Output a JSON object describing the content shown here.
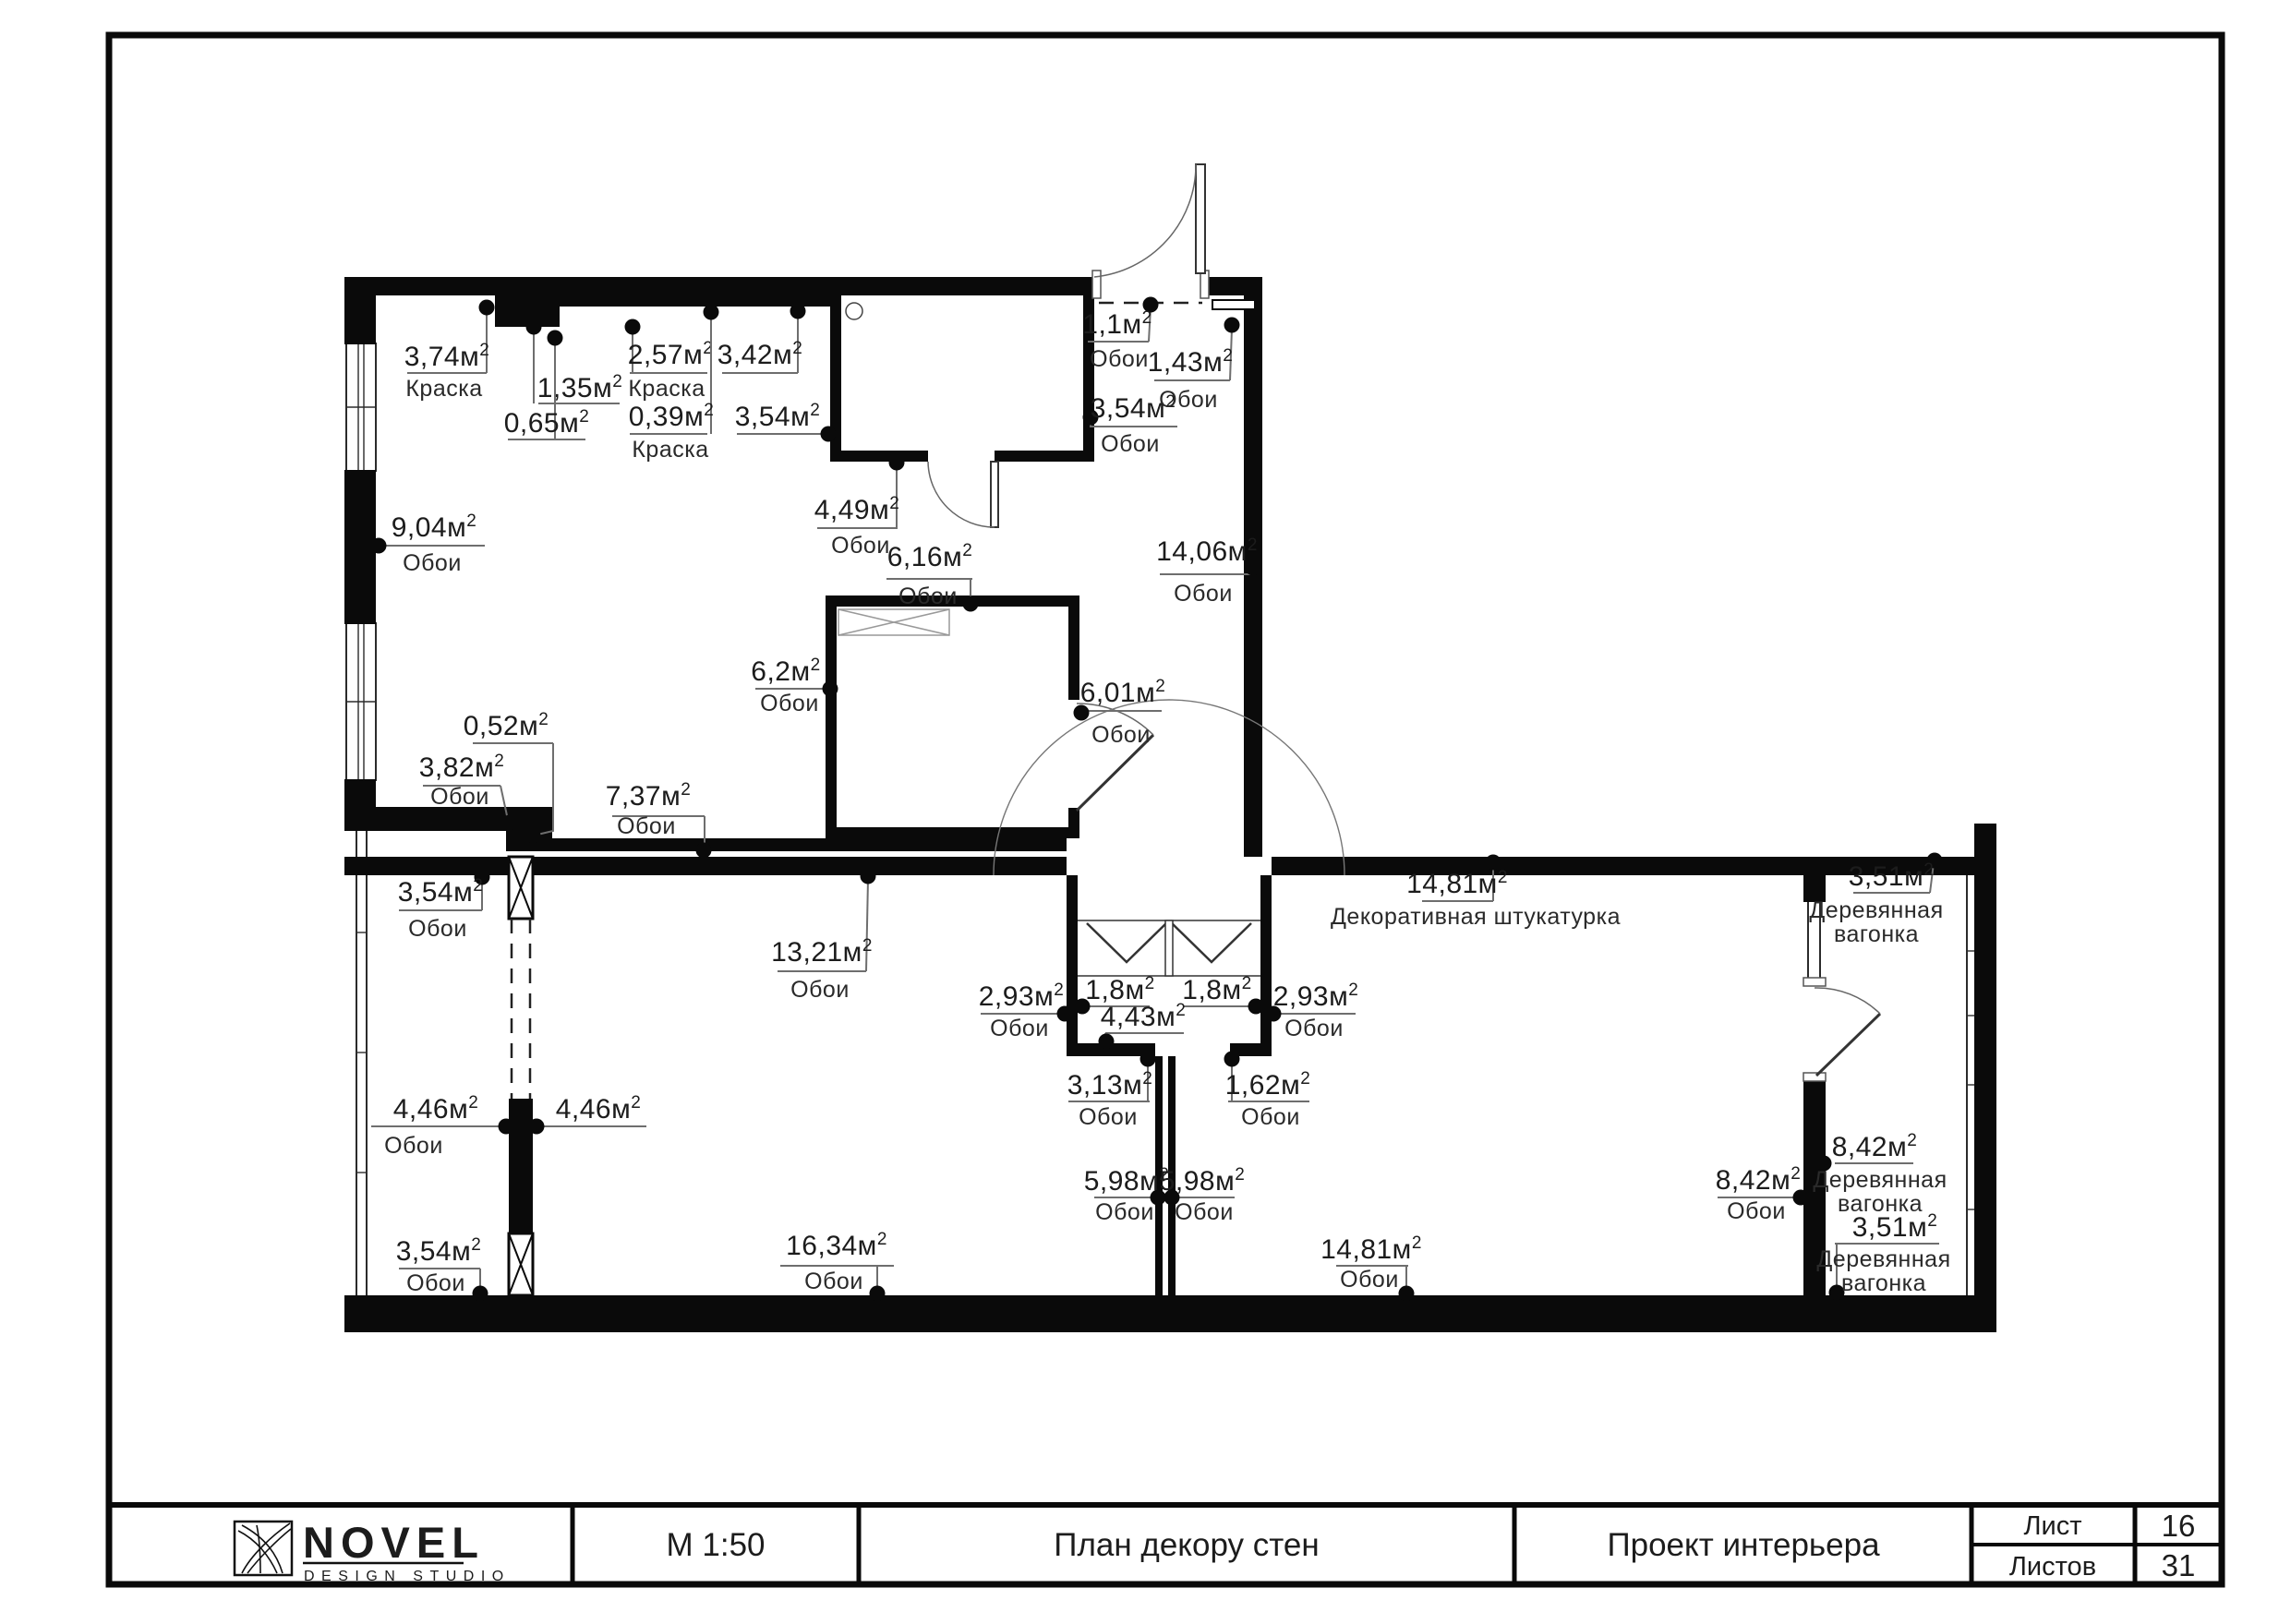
{
  "title_block": {
    "logo_name": "NOVEL",
    "logo_sub": "DESIGN STUDIO",
    "scale": "М 1:50",
    "drawing_title": "План декору стен",
    "project": "Проект интерьера",
    "sheet_label": "Лист",
    "sheet_value": "16",
    "sheets_label": "Листов",
    "sheets_value": "31"
  },
  "legend_note": "Площади стен и материалы отделки",
  "materials_palette": {
    "wallpaper": "Обои",
    "paint": "Краска",
    "decorative_plaster": "Декоративная штукатурка",
    "wood_paneling": "Деревянная вагонка"
  },
  "colors": {
    "walls": "#0a0a0a",
    "leaders": "#6e6e6e",
    "text": "#1c1c1c",
    "background": "#ffffff"
  },
  "labels": [
    {
      "value": "3,74м²",
      "material": "Краска",
      "vx": 484,
      "vy": 396,
      "ul": [
        441,
        527,
        404
      ],
      "mx": 481,
      "my": 429,
      "dot": [
        527,
        333
      ],
      "leader": [
        [
          527,
          404
        ],
        [
          527,
          336
        ]
      ]
    },
    {
      "value": "1,35м²",
      "material": "",
      "vx": 628,
      "vy": 430,
      "ul": [
        583,
        671,
        437
      ],
      "mx": 0,
      "my": 0,
      "dot": [
        578,
        354
      ],
      "leader": [
        [
          578,
          437
        ],
        [
          578,
          357
        ]
      ]
    },
    {
      "value": "0,65м²",
      "material": "",
      "vx": 592,
      "vy": 468,
      "ul": [
        550,
        634,
        476
      ],
      "mx": 0,
      "my": 0,
      "dot": [
        601,
        366
      ],
      "leader": [
        [
          601,
          476
        ],
        [
          601,
          369
        ]
      ]
    },
    {
      "value": "2,57м²",
      "material": "Краска",
      "vx": 726,
      "vy": 394,
      "ul": [
        682,
        766,
        404
      ],
      "mx": 722,
      "my": 429,
      "dot": [
        685,
        354
      ],
      "leader": [
        [
          685,
          404
        ],
        [
          685,
          357
        ]
      ]
    },
    {
      "value": "0,39м²",
      "material": "Краска",
      "vx": 727,
      "vy": 461,
      "ul": [
        682,
        766,
        470
      ],
      "mx": 726,
      "my": 495,
      "dot": [
        770,
        338
      ],
      "leader": [
        [
          770,
          470
        ],
        [
          770,
          341
        ]
      ]
    },
    {
      "value": "3,42м²",
      "material": "",
      "vx": 823,
      "vy": 394,
      "ul": [
        782,
        864,
        404
      ],
      "mx": 0,
      "my": 0,
      "dot": [
        864,
        337
      ],
      "leader": [
        [
          864,
          404
        ],
        [
          864,
          340
        ]
      ]
    },
    {
      "value": "3,54м²",
      "material": "",
      "vx": 842,
      "vy": 461,
      "ul": [
        798,
        885,
        470
      ],
      "mx": 0,
      "my": 0,
      "dot": [
        897,
        470
      ],
      "leader": [
        [
          885,
          470
        ],
        [
          892,
          470
        ]
      ]
    },
    {
      "value": "3,54м²",
      "material": "Обои",
      "vx": 1227,
      "vy": 452,
      "ul": [
        1180,
        1275,
        462
      ],
      "mx": 1224,
      "my": 489,
      "dot": [
        1181,
        452
      ],
      "leader": [
        [
          1181,
          462
        ],
        [
          1181,
          455
        ]
      ]
    },
    {
      "value": "1,1м²",
      "material": "Обои",
      "vx": 1210,
      "vy": 361,
      "ul": [
        1178,
        1244,
        370
      ],
      "mx": 1212,
      "my": 397,
      "dot": [
        1246,
        330
      ],
      "leader": [
        [
          1244,
          370
        ],
        [
          1246,
          333
        ]
      ]
    },
    {
      "value": "1,43м²",
      "material": "Обои",
      "vx": 1289,
      "vy": 402,
      "ul": [
        1250,
        1332,
        412
      ],
      "mx": 1287,
      "my": 441,
      "dot": [
        1334,
        352
      ],
      "leader": [
        [
          1332,
          412
        ],
        [
          1334,
          356
        ]
      ]
    },
    {
      "value": "4,49м²",
      "material": "Обои",
      "vx": 928,
      "vy": 562,
      "ul": [
        885,
        972,
        572
      ],
      "mx": 932,
      "my": 599,
      "dot": [
        971,
        501
      ],
      "leader": [
        [
          971,
          572
        ],
        [
          971,
          504
        ]
      ]
    },
    {
      "value": "9,04м²",
      "material": "Обои",
      "vx": 470,
      "vy": 581,
      "ul": [
        413,
        525,
        591
      ],
      "mx": 468,
      "my": 618,
      "dot": [
        410,
        591
      ],
      "leader": [
        [
          413,
          591
        ],
        [
          411,
          591
        ]
      ]
    },
    {
      "value": "6,16м²",
      "material": "Обои",
      "vx": 1007,
      "vy": 613,
      "ul": [
        960,
        1053,
        627
      ],
      "mx": 1005,
      "my": 654,
      "dot": [
        1051,
        654
      ],
      "leader": [
        [
          1051,
          627
        ],
        [
          1051,
          651
        ]
      ]
    },
    {
      "value": "14,06м²",
      "material": "Обои",
      "vx": 1307,
      "vy": 607,
      "ul": [
        1256,
        1356,
        622
      ],
      "mx": 1303,
      "my": 651,
      "dot": [
        1357,
        615
      ],
      "leader": [
        [
          1356,
          622
        ],
        [
          1357,
          618
        ]
      ]
    },
    {
      "value": "6,2м²",
      "material": "Обои",
      "vx": 851,
      "vy": 737,
      "ul": [
        818,
        893,
        746
      ],
      "mx": 855,
      "my": 770,
      "dot": [
        899,
        746
      ],
      "leader": [
        [
          893,
          746
        ],
        [
          896,
          746
        ]
      ]
    },
    {
      "value": "6,01м²",
      "material": "Обои",
      "vx": 1216,
      "vy": 760,
      "ul": [
        1174,
        1258,
        770
      ],
      "mx": 1214,
      "my": 804,
      "dot": [
        1171,
        772
      ],
      "leader": [
        [
          1174,
          770
        ],
        [
          1172,
          771
        ]
      ]
    },
    {
      "value": "0,52м²",
      "material": "",
      "vx": 548,
      "vy": 796,
      "ul": [
        512,
        599,
        805
      ],
      "mx": 0,
      "my": 0,
      "dot": [
        577,
        905
      ],
      "leader": [
        [
          599,
          805
        ],
        [
          599,
          900
        ],
        [
          582,
          904
        ]
      ]
    },
    {
      "value": "3,82м²",
      "material": "Обои",
      "vx": 500,
      "vy": 841,
      "ul": [
        458,
        542,
        851
      ],
      "mx": 498,
      "my": 871,
      "dot": [
        552,
        891
      ],
      "leader": [
        [
          542,
          851
        ],
        [
          550,
          888
        ]
      ]
    },
    {
      "value": "7,37м²",
      "material": "Обои",
      "vx": 702,
      "vy": 872,
      "ul": [
        663,
        763,
        884
      ],
      "mx": 700,
      "my": 903,
      "dot": [
        762,
        921
      ],
      "leader": [
        [
          763,
          884
        ],
        [
          763,
          918
        ]
      ]
    },
    {
      "value": "3,54м²",
      "material": "Обои",
      "vx": 477,
      "vy": 976,
      "ul": [
        432,
        522,
        986
      ],
      "mx": 474,
      "my": 1014,
      "dot": [
        522,
        950
      ],
      "leader": [
        [
          522,
          986
        ],
        [
          522,
          953
        ]
      ]
    },
    {
      "value": "13,21м²",
      "material": "Обои",
      "vx": 890,
      "vy": 1041,
      "ul": [
        842,
        938,
        1052
      ],
      "mx": 888,
      "my": 1080,
      "dot": [
        940,
        949
      ],
      "leader": [
        [
          938,
          1052
        ],
        [
          940,
          952
        ]
      ]
    },
    {
      "value": "4,46м²",
      "material": "Обои",
      "vx": 472,
      "vy": 1211,
      "ul": [
        402,
        545,
        1220
      ],
      "mx": 448,
      "my": 1249,
      "dot": [
        548,
        1220
      ],
      "leader": []
    },
    {
      "value": "4,46м²",
      "material": "",
      "vx": 648,
      "vy": 1211,
      "ul": [
        580,
        700,
        1220
      ],
      "mx": 0,
      "my": 0,
      "dot": [
        581,
        1220
      ],
      "leader": []
    },
    {
      "value": "3,54м²",
      "material": "Обои",
      "vx": 475,
      "vy": 1365,
      "ul": [
        432,
        520,
        1374
      ],
      "mx": 472,
      "my": 1398,
      "dot": [
        520,
        1401
      ],
      "leader": [
        [
          520,
          1374
        ],
        [
          520,
          1398
        ]
      ]
    },
    {
      "value": "16,34м²",
      "material": "Обои",
      "vx": 906,
      "vy": 1359,
      "ul": [
        845,
        968,
        1371
      ],
      "mx": 903,
      "my": 1396,
      "dot": [
        950,
        1401
      ],
      "leader": [
        [
          950,
          1371
        ],
        [
          950,
          1398
        ]
      ]
    },
    {
      "value": "2,93м²",
      "material": "Обои",
      "vx": 1106,
      "vy": 1089,
      "ul": [
        1062,
        1148,
        1098
      ],
      "mx": 1104,
      "my": 1122,
      "dot": [
        1153,
        1098
      ],
      "leader": []
    },
    {
      "value": "1,8м²",
      "material": "",
      "vx": 1213,
      "vy": 1082,
      "ul": [
        1177,
        1245,
        1090
      ],
      "mx": 0,
      "my": 0,
      "dot": [
        1172,
        1090
      ],
      "leader": []
    },
    {
      "value": "1,8м²",
      "material": "",
      "vx": 1318,
      "vy": 1082,
      "ul": [
        1282,
        1352,
        1090
      ],
      "mx": 0,
      "my": 0,
      "dot": [
        1360,
        1090
      ],
      "leader": []
    },
    {
      "value": "2,93м²",
      "material": "Обои",
      "vx": 1425,
      "vy": 1089,
      "ul": [
        1382,
        1468,
        1098
      ],
      "mx": 1423,
      "my": 1122,
      "dot": [
        1379,
        1098
      ],
      "leader": []
    },
    {
      "value": "4,43м²",
      "material": "",
      "vx": 1238,
      "vy": 1111,
      "ul": [
        1197,
        1282,
        1119
      ],
      "mx": 0,
      "my": 0,
      "dot": [
        1198,
        1128
      ],
      "leader": [
        [
          1197,
          1119
        ],
        [
          1198,
          1126
        ]
      ]
    },
    {
      "value": "3,13м²",
      "material": "Обои",
      "vx": 1202,
      "vy": 1185,
      "ul": [
        1157,
        1245,
        1193
      ],
      "mx": 1200,
      "my": 1218,
      "dot": [
        1243,
        1147
      ],
      "leader": [
        [
          1243,
          1193
        ],
        [
          1243,
          1150
        ]
      ]
    },
    {
      "value": "1,62м²",
      "material": "Обои",
      "vx": 1373,
      "vy": 1185,
      "ul": [
        1330,
        1418,
        1193
      ],
      "mx": 1376,
      "my": 1218,
      "dot": [
        1334,
        1147
      ],
      "leader": [
        [
          1334,
          1193
        ],
        [
          1334,
          1150
        ]
      ]
    },
    {
      "value": "5,98м²",
      "material": "Обои",
      "vx": 1220,
      "vy": 1289,
      "ul": [
        1185,
        1253,
        1297
      ],
      "mx": 1218,
      "my": 1321,
      "dot": [
        1254,
        1297
      ],
      "leader": []
    },
    {
      "value": "5,98м²",
      "material": "Обои",
      "vx": 1302,
      "vy": 1289,
      "ul": [
        1268,
        1337,
        1297
      ],
      "mx": 1304,
      "my": 1321,
      "dot": [
        1269,
        1297
      ],
      "leader": []
    },
    {
      "value": "14,81м²",
      "material": "Обои",
      "vx": 1485,
      "vy": 1363,
      "ul": [
        1447,
        1525,
        1371
      ],
      "mx": 1483,
      "my": 1394,
      "dot": [
        1523,
        1401
      ],
      "leader": [
        [
          1523,
          1371
        ],
        [
          1523,
          1398
        ]
      ]
    },
    {
      "value": "14,81м²",
      "material": "Декоративная штукатурка",
      "vx": 1578,
      "vy": 967,
      "ul": [
        1540,
        1617,
        976
      ],
      "mx": 1598,
      "my": 1001,
      "dot": [
        1617,
        934
      ],
      "leader": [
        [
          1617,
          976
        ],
        [
          1617,
          937
        ]
      ]
    },
    {
      "value": "3,51м²",
      "material": "Деревянная\nвагонка",
      "vx": 2048,
      "vy": 959,
      "ul": [
        2007,
        2090,
        967
      ],
      "mx": 2032,
      "my": 994,
      "dot": [
        2095,
        932
      ],
      "leader": [
        [
          2090,
          967
        ],
        [
          2094,
          935
        ]
      ]
    },
    {
      "value": "8,42м²",
      "material": "Обои",
      "vx": 1904,
      "vy": 1288,
      "ul": [
        1860,
        1948,
        1297
      ],
      "mx": 1902,
      "my": 1320,
      "dot": [
        1950,
        1297
      ],
      "leader": []
    },
    {
      "value": "8,42м²",
      "material": "Деревянная\nвагонка",
      "vx": 2030,
      "vy": 1252,
      "ul": [
        1987,
        2072,
        1260
      ],
      "mx": 2036,
      "my": 1286,
      "dot": [
        1975,
        1260
      ],
      "leader": []
    },
    {
      "value": "3,51м²",
      "material": "Деревянная\nвагонка",
      "vx": 2052,
      "vy": 1339,
      "ul": [
        1987,
        2100,
        1347
      ],
      "mx": 2040,
      "my": 1372,
      "dot": [
        1989,
        1400
      ],
      "leader": [
        [
          1989,
          1347
        ],
        [
          1989,
          1397
        ]
      ]
    }
  ]
}
